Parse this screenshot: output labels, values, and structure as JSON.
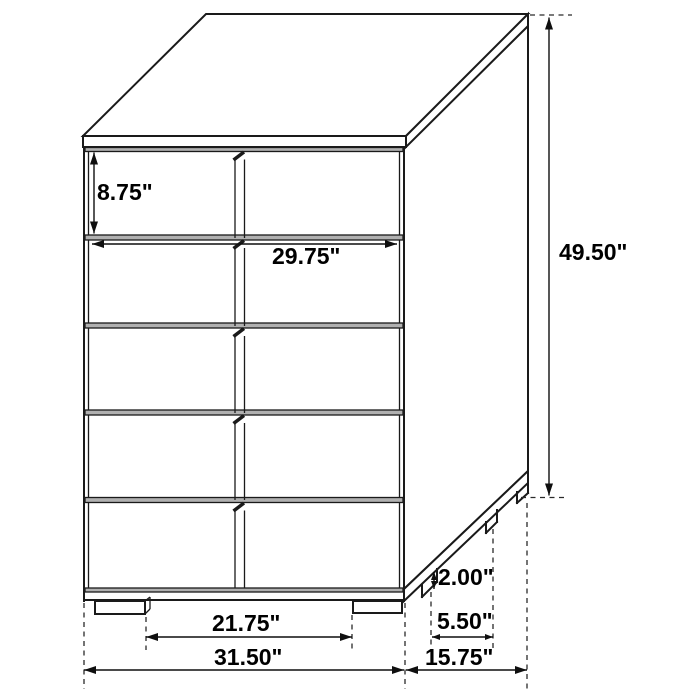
{
  "diagram": {
    "subject": "chest-of-drawers",
    "view": "three-quarter oblique line drawing with dimension callouts",
    "drawer_count": 5,
    "unit": "inches",
    "dimensions": {
      "drawer_height": {
        "label": "8.75\"",
        "value": 8.75,
        "measures": "top drawer front height"
      },
      "interior_width": {
        "label": "29.75\"",
        "value": 29.75,
        "measures": "drawer front width"
      },
      "overall_height": {
        "label": "49.50\"",
        "value": 49.5,
        "measures": "overall height"
      },
      "leg_height": {
        "label": "2.00\"",
        "value": 2.0,
        "measures": "leg height"
      },
      "leg_depth": {
        "label": "5.50\"",
        "value": 5.5,
        "measures": "leg footprint depth"
      },
      "leg_spacing": {
        "label": "21.75\"",
        "value": 21.75,
        "measures": "clearance between front legs"
      },
      "overall_width": {
        "label": "31.50\"",
        "value": 31.5,
        "measures": "overall width"
      },
      "overall_depth": {
        "label": "15.75\"",
        "value": 15.75,
        "measures": "overall depth"
      }
    },
    "colors": {
      "background": "#ffffff",
      "line": "#1a1a1a",
      "groove_fill": "#b0b0b0",
      "label_text": "#000000"
    }
  }
}
